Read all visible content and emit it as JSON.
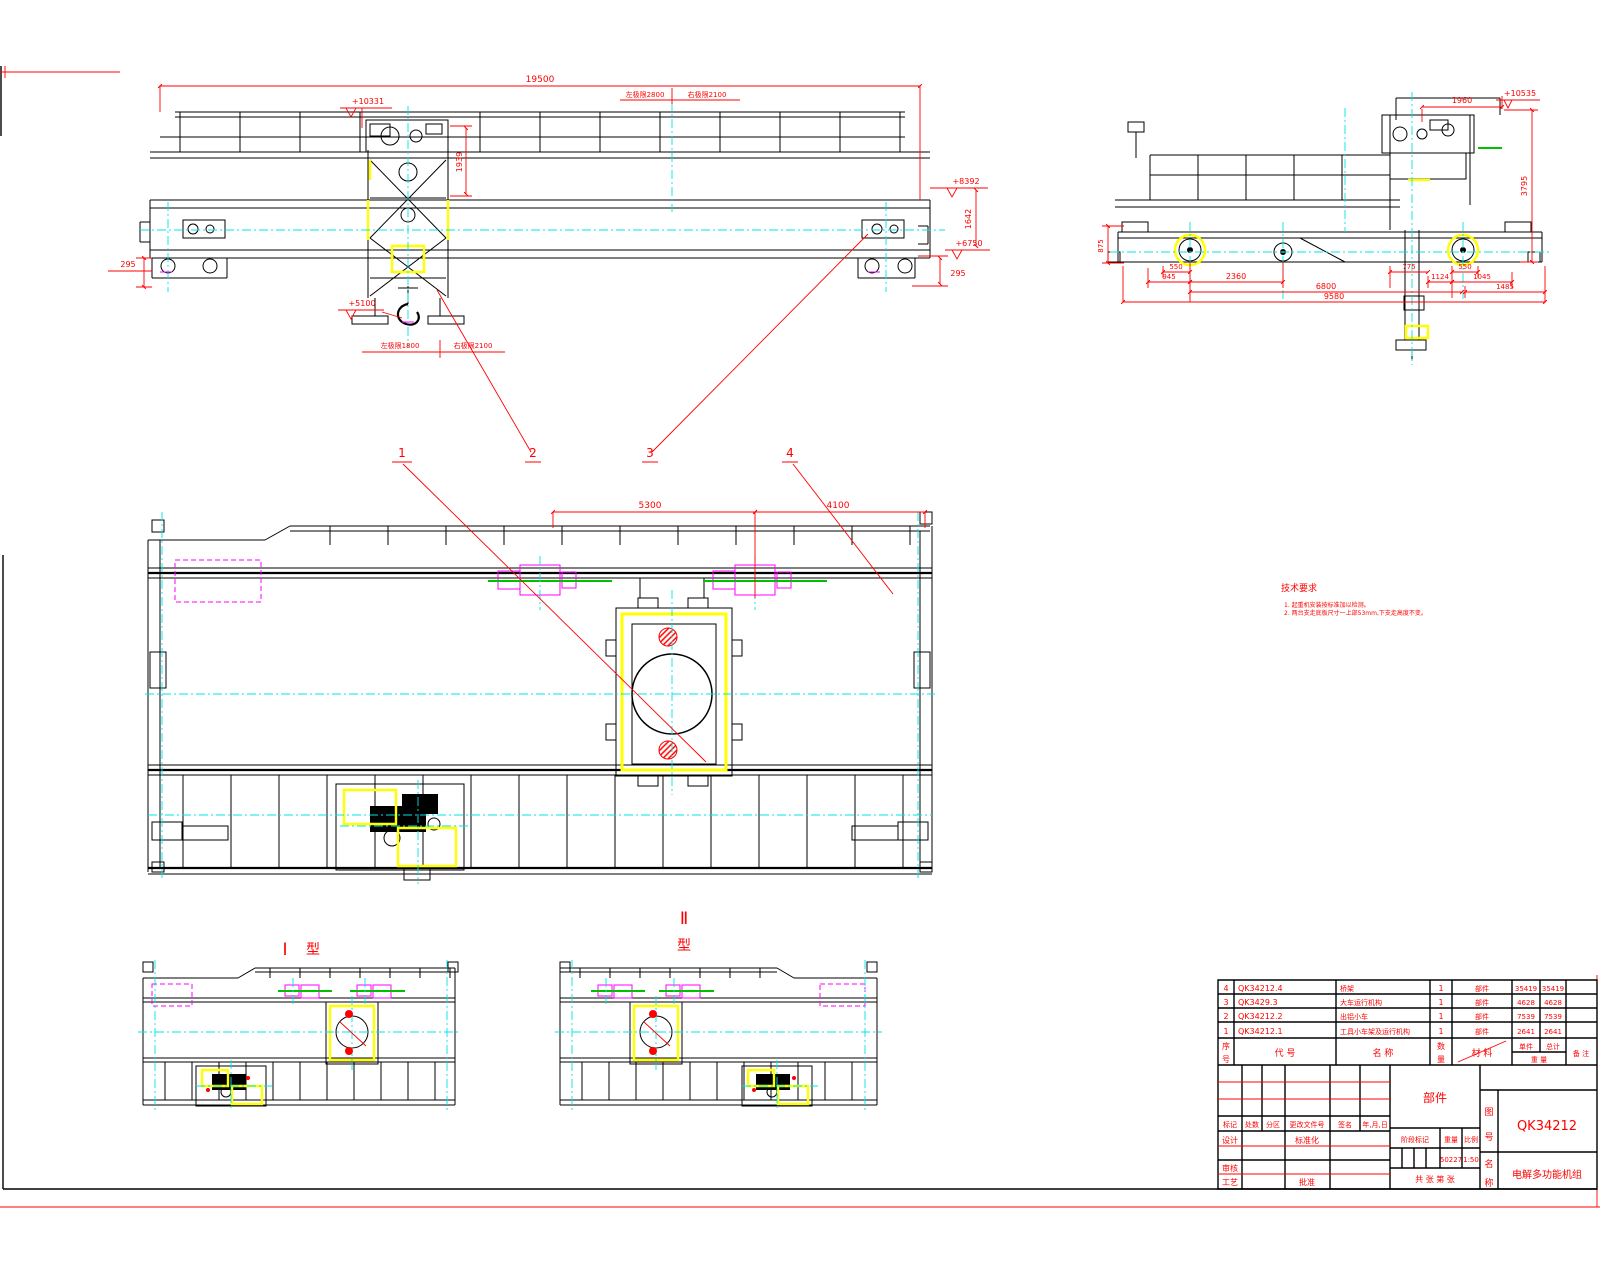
{
  "drawing": {
    "front_view": {
      "dim_span": "19500",
      "elev_trolley_top": "+10331",
      "dim_trolley_height": "1939",
      "limit_top_left": "左极限2800",
      "limit_top_right": "右极限2100",
      "elev_girder_top": "+8392",
      "dim_girder_end": "1642",
      "elev_rail": "+6750",
      "dim_wheel_left": "295",
      "dim_wheel_right": "295",
      "elev_hook": "+5100",
      "limit_hook_left": "左极限1800",
      "limit_hook_right": "右极限2100"
    },
    "side_view": {
      "dim_top": "1960",
      "elev_top": "+10535",
      "dim_height": "3795",
      "dim_frame_height": "875",
      "dim_550_left": "550",
      "dim_945": "945",
      "dim_2360": "2360",
      "dim_775": "775",
      "dim_1124": "1124",
      "dim_550_right": "550",
      "dim_1045": "1045",
      "dim_1485": "1485",
      "dim_6800": "6800",
      "dim_9580": "9580"
    },
    "plan_view": {
      "dim_5300": "5300",
      "dim_4100": "4100",
      "callout_1": "1",
      "callout_2": "2",
      "callout_3": "3",
      "callout_4": "4"
    },
    "type_views": {
      "type1_numeral": "Ⅰ",
      "type1_suffix": "型",
      "type2_numeral": "Ⅱ",
      "type2_suffix": "型"
    }
  },
  "notes": {
    "title": "技术要求",
    "item1": "1. 起重机安装按标准加以检测。",
    "item2": "2. 两台支走底板尺寸一上部53mm,下支走高度不变。"
  },
  "bom": {
    "headers": {
      "seq_top": "序",
      "seq_bottom": "号",
      "code": "代  号",
      "name": "名  称",
      "qty_top": "数",
      "qty_bottom": "量",
      "material": "材  料",
      "unit": "单件",
      "total": "总计",
      "weight": "重 量",
      "remark": "备 注"
    },
    "rows": [
      {
        "seq": "4",
        "code": "QK34212.4",
        "name": "桥架",
        "qty": "1",
        "material": "部件",
        "unit": "35419",
        "total": "35419"
      },
      {
        "seq": "3",
        "code": "QK3429.3",
        "name": "大车运行机构",
        "qty": "1",
        "material": "部件",
        "unit": "4628",
        "total": "4628"
      },
      {
        "seq": "2",
        "code": "QK34212.2",
        "name": "出铝小车",
        "qty": "1",
        "material": "部件",
        "unit": "7539",
        "total": "7539"
      },
      {
        "seq": "1",
        "code": "QK34212.1",
        "name": "工具小车架及运行机构",
        "qty": "1",
        "material": "部件",
        "unit": "2641",
        "total": "2641"
      }
    ]
  },
  "title_block": {
    "rev_headers": {
      "mark": "标记",
      "count": "处数",
      "zone": "分区",
      "doc_no": "更改文件号",
      "sign": "签名",
      "date": "年,月,日"
    },
    "roles": {
      "design": "设计",
      "standardization": "标准化",
      "check": "审核",
      "process": "工艺",
      "approve": "批准"
    },
    "part_type": "部件",
    "stage_label": "阶段标记",
    "weight_label": "重量",
    "scale_label": "比例",
    "weight_value": "50227",
    "scale_value": "1:50",
    "sheet_label": "共  张  第  张",
    "dno_top": "图",
    "dno_bottom": "号",
    "drawing_no": "QK34212",
    "name_top": "名",
    "name_bottom": "称",
    "product_name": "电解多功能机组"
  }
}
